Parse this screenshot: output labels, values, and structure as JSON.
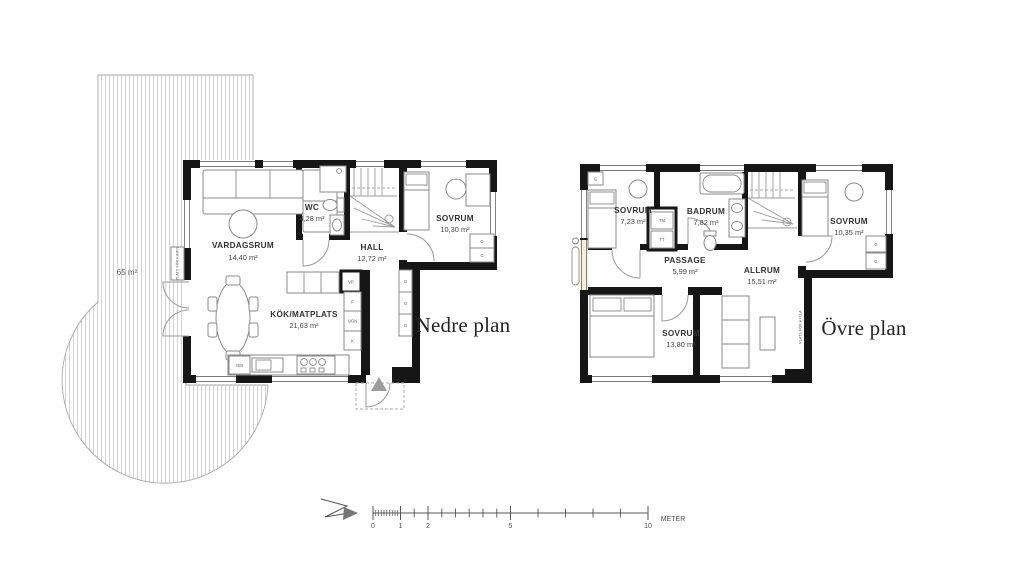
{
  "lower": {
    "title": "Nedre plan",
    "deck_area": "65 m²",
    "rooms": [
      {
        "name": "VARDAGSRUM",
        "area": "14,40 m²"
      },
      {
        "name": "WC",
        "area": "4,28 m²"
      },
      {
        "name": "HALL",
        "area": "12,72 m²"
      },
      {
        "name": "SOVRUM",
        "area": "10,30 m²"
      },
      {
        "name": "KÖK/MATPLATS",
        "area": "21,63 m²"
      }
    ],
    "appliances": {
      "dm": "DM",
      "vp": "VP",
      "f": "F",
      "ugn": "UGN",
      "k": "K"
    },
    "notes": {
      "kamin": "PLATS FÖR KAMIN"
    }
  },
  "upper": {
    "title": "Övre plan",
    "rooms": [
      {
        "name": "SOVRUM",
        "area": "7,23 m²"
      },
      {
        "name": "BADRUM",
        "area": "7,82 m²"
      },
      {
        "name": "SOVRUM",
        "area": "10,35 m²"
      },
      {
        "name": "PASSAGE",
        "area": "5,99 m²"
      },
      {
        "name": "ALLRUM",
        "area": "15,51 m²"
      },
      {
        "name": "SOVRUM",
        "area": "13,80 m²"
      }
    ],
    "appliances": {
      "tm": "TM",
      "tt": "TT"
    },
    "notes": {
      "hylla": "PLATS FÖR HYLLA"
    }
  },
  "labels": {
    "closet": "G"
  },
  "scale": {
    "ticks": [
      "0",
      "1",
      "2",
      "5",
      "10"
    ],
    "unit": "METER"
  }
}
